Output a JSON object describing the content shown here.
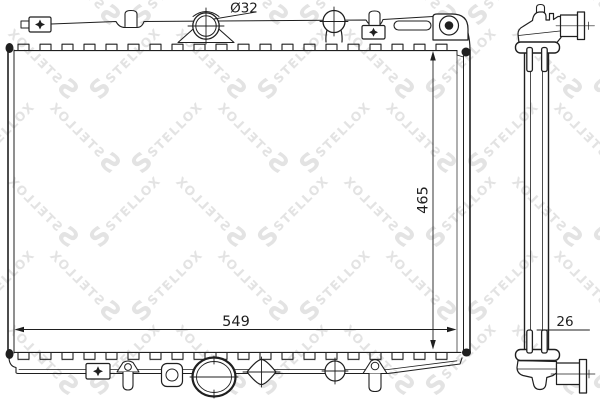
{
  "labels": {
    "neck_diameter": "Ø32",
    "width": "549",
    "height": "465",
    "depth": "26"
  },
  "watermark": {
    "text": "STELLOX",
    "logo": "S",
    "color": "#e3e3e3"
  },
  "colors": {
    "line": "#1f1f1f",
    "background": "#ffffff"
  }
}
